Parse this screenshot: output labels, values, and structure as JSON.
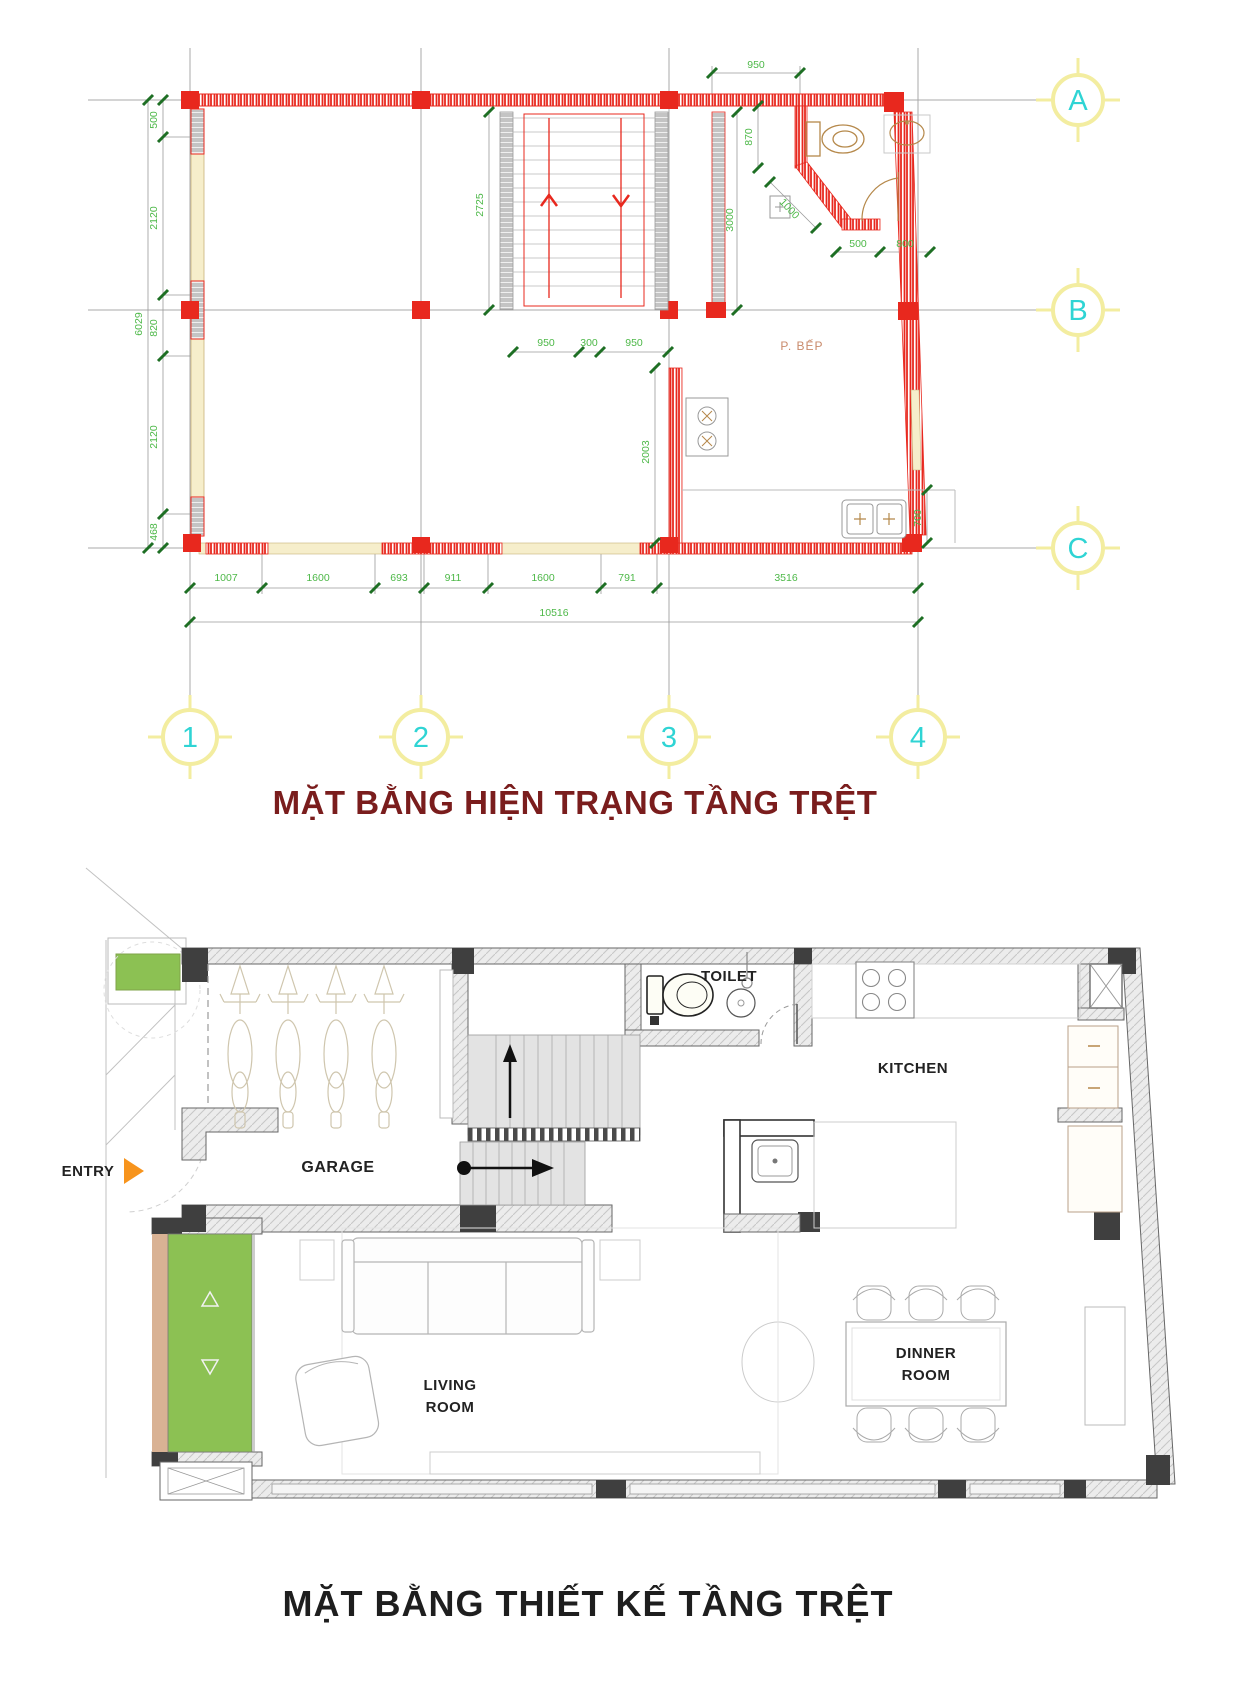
{
  "colors": {
    "wall_red": "#e8281e",
    "dim_green": "#4db848",
    "tick_green": "#1e6f24",
    "grid_gray": "#a8a8a8",
    "bubble_yellow": "#f3eda0",
    "cyan": "#2fd4d4",
    "cream": "#f6eecb",
    "fixture_tan": "#b5884a",
    "room_tan": "#c98a6b",
    "title_existing": "#7a1d1d",
    "title_design": "#1e1e1e",
    "planter_green": "#8cc153",
    "tan": "#d9b294",
    "orange": "#f7941d",
    "dark": "#3f3f3f"
  },
  "cad_plan": {
    "title": "MẶT BẰNG HIỆN TRẠNG TẦNG TRỆT",
    "grid_rows": [
      "A",
      "B",
      "C"
    ],
    "grid_cols": [
      "1",
      "2",
      "3",
      "4"
    ],
    "room_label": "P. BẾP",
    "dims": {
      "top": "950",
      "left": [
        "500",
        "2120",
        "820",
        "2120",
        "468"
      ],
      "left_total": "6029",
      "stair_length": "2725",
      "hall_depth": "3000",
      "wc_depth": "870",
      "wc_diag": "1000",
      "wc_a": "500",
      "wc_b": "800",
      "stair_width": [
        "950",
        "300",
        "950"
      ],
      "kitchen_depth": "2003",
      "sink_depth": "700",
      "bottom": [
        "1007",
        "1600",
        "693",
        "911",
        "1600",
        "791",
        "3516"
      ],
      "bottom_total": "10516"
    }
  },
  "design_plan": {
    "title": "MẶT BẰNG THIẾT KẾ TẦNG TRỆT",
    "labels": {
      "entry": "ENTRY",
      "garage": "GARAGE",
      "toilet": "TOILET",
      "kitchen": "KITCHEN",
      "living_1": "LIVING",
      "living_2": "ROOM",
      "dinner_1": "DINNER",
      "dinner_2": "ROOM"
    }
  }
}
